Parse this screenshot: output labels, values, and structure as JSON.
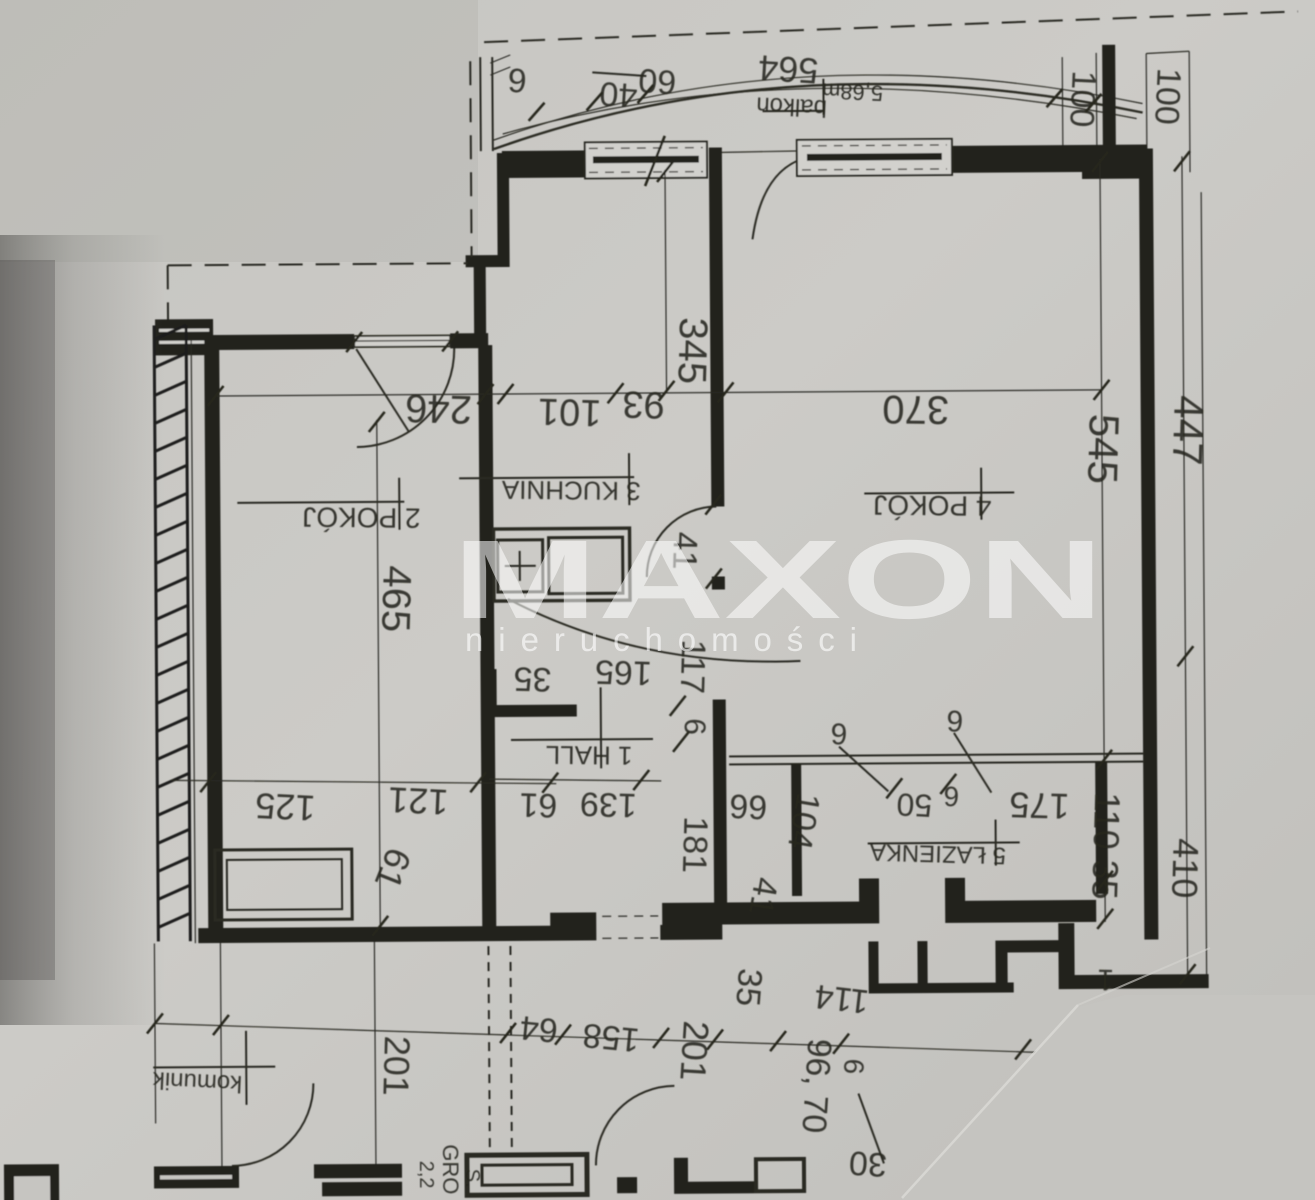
{
  "watermark": {
    "title": "MAXON",
    "subtitle": "nieruchomości",
    "color": "#ffffff"
  },
  "rooms": {
    "hall": "1 HALL",
    "room2": "2 POKÓJ",
    "kitchen": "3 KUCHNIA",
    "room4": "4 POKÓJ",
    "bath": "5 ŁAZIENKA",
    "corridor": "komunik",
    "balcony": "balkon",
    "balcony_area": "5,68m"
  },
  "dims": {
    "d6_balcony": "6",
    "d40": "40",
    "d60": "60",
    "d564": "564",
    "d100_a": "100",
    "d100_b": "100",
    "d246": "246",
    "d101": "101",
    "d93": "93",
    "d370": "370",
    "d345": "345",
    "d545": "545",
    "d447": "447",
    "d465": "465",
    "d41_kitchen": "41",
    "d41_bath": "41",
    "d35_hall": "35",
    "d165": "165",
    "d117": "117",
    "d6_hall": "6",
    "d66": "66",
    "d61_hall": "61",
    "d139": "139",
    "d181": "181",
    "d104": "104",
    "d6_bath_a": "6",
    "d6_bath_b": "6",
    "d50": "50",
    "d6_bath_c": "6",
    "d175": "175",
    "d110_35": "110 35",
    "d410": "410",
    "d125": "125",
    "d121": "121",
    "d61_room2": "61",
    "d35_lower": "35",
    "d114": "114",
    "d96_70": "96, 70",
    "d6_lower": "6",
    "d30": "30",
    "d201_mid": "201",
    "d158": "158",
    "d64": "64",
    "d201_left": "201",
    "d1_partial": "1"
  },
  "partial_text": {
    "gro": "GRO",
    "g22": "2,2",
    "gs": "S."
  },
  "colors": {
    "paper": "#cac9c5",
    "ink": "#26261f"
  }
}
